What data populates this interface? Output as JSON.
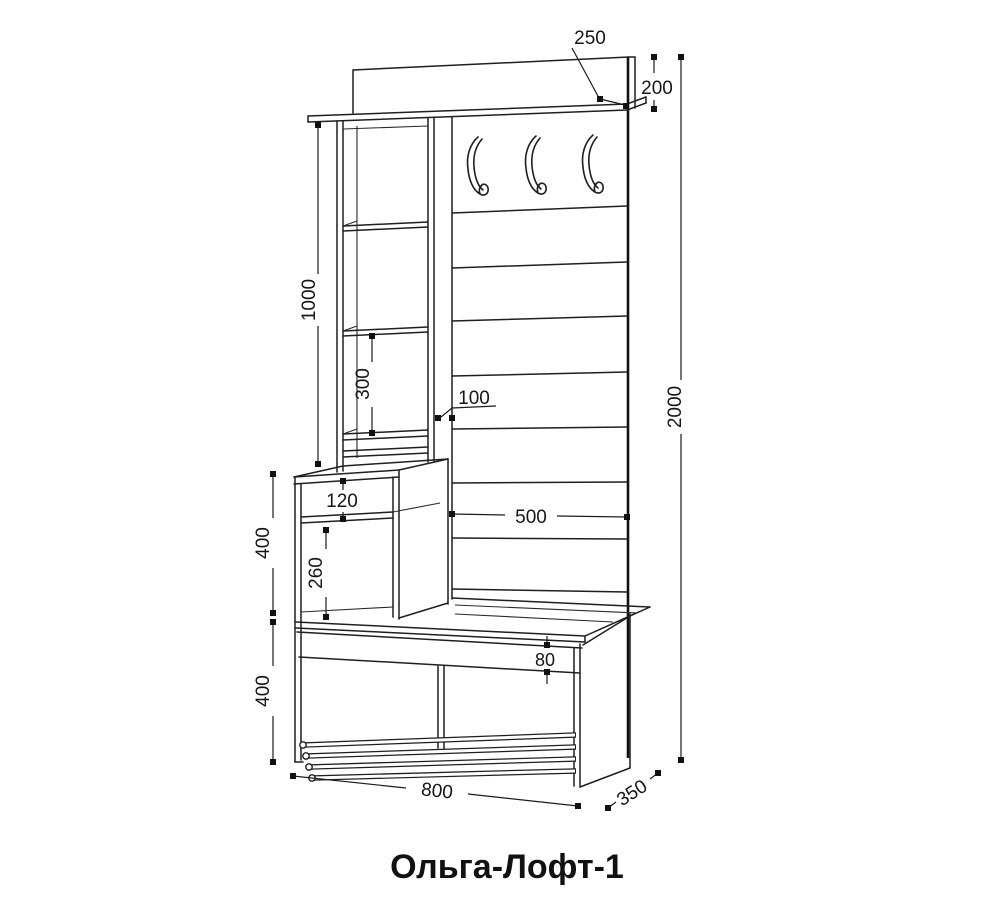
{
  "title": "Ольга-Лофт-1",
  "drawing": {
    "type": "furniture-technical-drawing",
    "product": "Ольга-Лофт-1",
    "dims": {
      "shelf_depth": "250",
      "top_gap": "200",
      "overall_height": "2000",
      "tower_height": "1000",
      "shelf_spacing": "300",
      "divider_depth": "100",
      "cabinet_upper_opening": "120",
      "cabinet_section_height": "400",
      "cabinet_lower_opening": "260",
      "back_panel_width": "500",
      "seat_apron_height": "80",
      "bench_section_height": "400",
      "overall_width": "800",
      "overall_depth": "350"
    }
  }
}
